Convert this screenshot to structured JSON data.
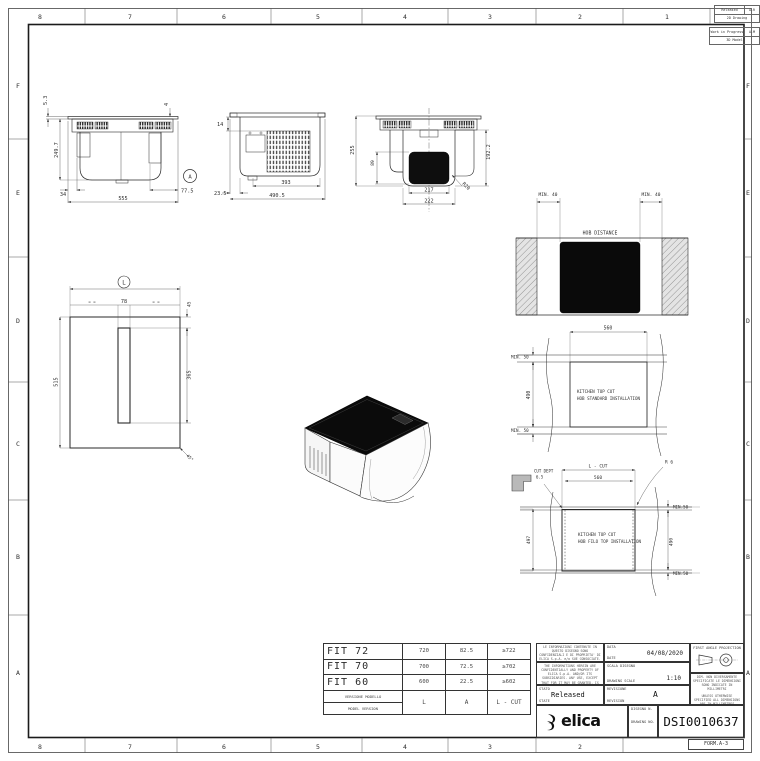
{
  "sheet": {
    "form_label": "FORM.A-3",
    "zone_cols": [
      "8",
      "7",
      "6",
      "5",
      "4",
      "3",
      "2",
      "1"
    ],
    "zone_rows": [
      "F",
      "E",
      "D",
      "C",
      "B",
      "A"
    ],
    "status_tables": [
      {
        "status": "Released",
        "code": "A-R",
        "scope": "2D Drawing"
      },
      {
        "status": "Work in Progress",
        "code": "A-M",
        "scope": "3D Model"
      }
    ]
  },
  "views": {
    "front": {
      "thickness": "5.3",
      "height": "249.7",
      "offset_left": "34",
      "width": "555",
      "offset_right": "77.5",
      "trim": "4",
      "detail": "A"
    },
    "side": {
      "top_gap": "14",
      "bottom_offset": "23.5",
      "grille_width": "393",
      "body_width": "490.5"
    },
    "duct": {
      "height": "255",
      "body_height": "192.2",
      "outlet_height": "89",
      "outlet_width": "217",
      "duct_width": "222",
      "radius": "R20"
    },
    "plan": {
      "width_ref": "L",
      "slot_width": "78",
      "slot_offset": "45",
      "height": "515",
      "slot_length": "365",
      "corner_angle": "45°",
      "equal_marks": "= ="
    },
    "hob_distance": {
      "label": "HOB DISTANCE",
      "min_left": "MIN. 40",
      "min_right": "MIN. 40"
    },
    "standard_cut": {
      "width": "560",
      "height": "490",
      "min_top": "MIN. 50",
      "min_bottom": "MIN. 50",
      "line1": "KITCHEN TOP CUT",
      "line2": "HOB STANDARD INSTALLATION"
    },
    "filo_cut": {
      "width_ref": "L - CUT",
      "width": "560",
      "cut_depth_label": "CUT DEPT",
      "cut_depth": "6.5",
      "radius": "R 6",
      "min_top": "MIN.50",
      "min_bottom": "MIN.50",
      "height": "490",
      "outer_height": "497",
      "line1": "KITCHEN TOP CUT",
      "line2": "HOB FILO TOP INSTALLATION"
    }
  },
  "fit_table": {
    "rows": [
      {
        "model": "FIT 72",
        "l": "720",
        "a": "82.5",
        "lcut": "≥722"
      },
      {
        "model": "FIT 70",
        "l": "700",
        "a": "72.5",
        "lcut": "≥702"
      },
      {
        "model": "FIT 60",
        "l": "600",
        "a": "22.5",
        "lcut": "≥602"
      }
    ],
    "footer": {
      "label_it": "VERSIONE MODELLO",
      "label_en": "MODEL VERSION",
      "l": "L",
      "a": "A",
      "lcut": "L - CUT"
    }
  },
  "title_block": {
    "confidential_it": "LE INFORMAZIONI CONTENUTE IN QUESTO DISEGNO SONO CONFIDENZIALI E DI PROPRIETA' DI ELICA S.p.A. e/o SUE CONSOCIATE. OGNI UTILIZZO, ECCETTO QUELLI AUTORIZZATI, E' PROIBITO.",
    "confidential_en": "THE INFORMATIONS HEREIN ARE CONFIDENTIALLY AND PROPERTY OF ELICA S.p.A. AND/OR ITS SUBSIDIARIES. ANY USE, EXCEPT THAT FOR IT MAY BE GRANTED, IS PROHIBITED.",
    "date_label_it": "DATA",
    "date_label_en": "DATE",
    "date_value": "04/08/2020",
    "scale_label_it": "SCALA DISEGNO",
    "scale_label_en": "DRAWING SCALE",
    "scale_value": "1:10",
    "state_label_it": "STATO",
    "state_label_en": "STATE",
    "state_value": "Released",
    "revision_label_it": "REVISIONE",
    "revision_label_en": "REVISION",
    "revision_value": "A",
    "projection_label": "FIRST ANGLE PROJECTION",
    "units_note_it": "DIM. NON DIVERSAMENTE SPECIFICATE LE DIMENSIONI SONO INDICATE IN MILLIMETRI",
    "units_note_en": "UNLESS OTHERWISE SPECIFIED ALL DIMENSIONS ARE IN MILLIMETRES",
    "brand": "elica",
    "drawing_no_label_it": "DISEGNO N.",
    "drawing_no_label_en": "DRAWING NO.",
    "drawing_no": "DSI0010637"
  }
}
